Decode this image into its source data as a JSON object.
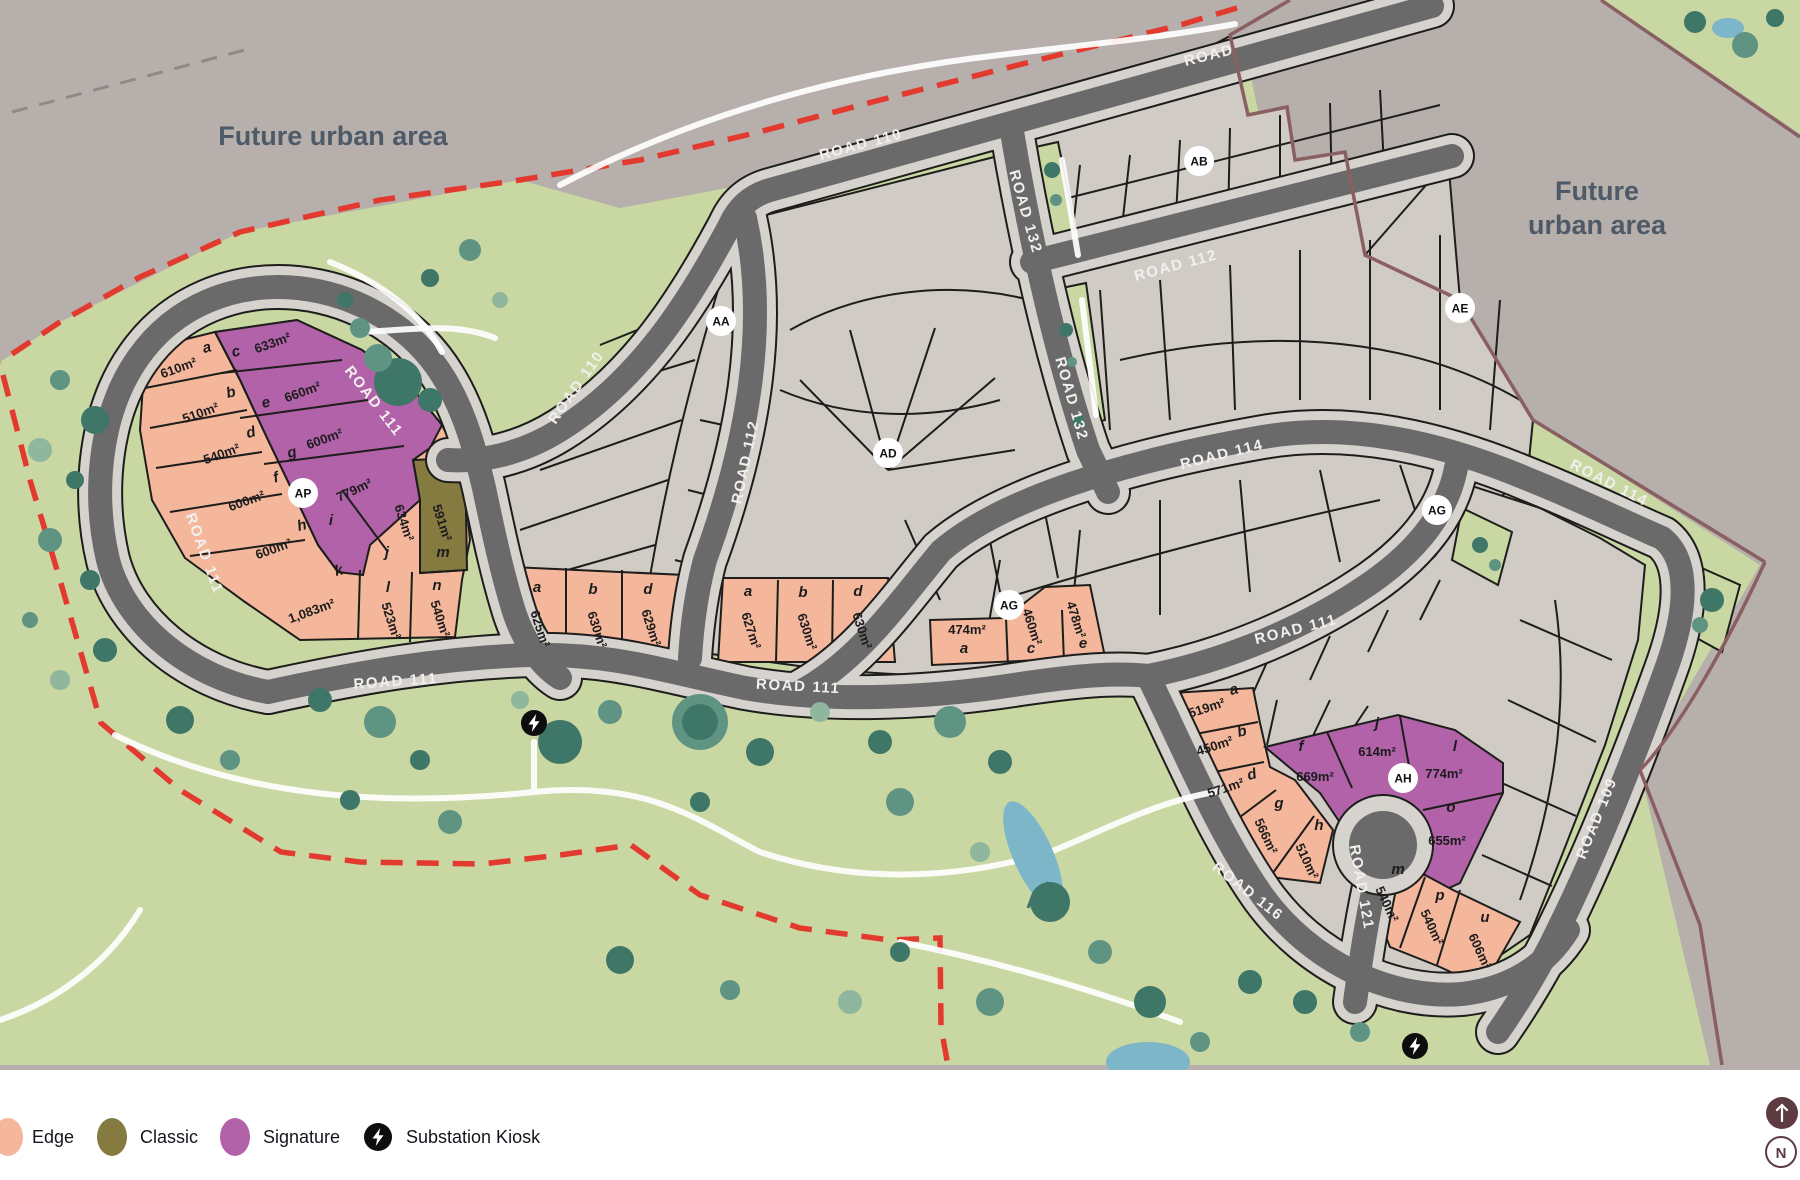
{
  "title": "Masterplan stage map",
  "future_area_labels": [
    {
      "lines": [
        "Future urban area"
      ],
      "x": 333,
      "y": 145
    },
    {
      "lines": [
        "Future",
        "urban area"
      ],
      "x": 1597,
      "y": 200
    }
  ],
  "road_labels": [
    {
      "text": "ROAD 110",
      "x": 862,
      "y": 149,
      "rot": -15
    },
    {
      "text": "ROAD",
      "x": 1210,
      "y": 60,
      "rot": -14
    },
    {
      "text": "ROAD 110",
      "x": 580,
      "y": 390,
      "rot": -55
    },
    {
      "text": "ROAD 111",
      "x": 370,
      "y": 404,
      "rot": 52
    },
    {
      "text": "ROAD 111",
      "x": 200,
      "y": 555,
      "rot": 70
    },
    {
      "text": "ROAD 111",
      "x": 396,
      "y": 686,
      "rot": -4
    },
    {
      "text": "ROAD 111",
      "x": 798,
      "y": 691,
      "rot": 3
    },
    {
      "text": "ROAD 111",
      "x": 1297,
      "y": 634,
      "rot": -14
    },
    {
      "text": "ROAD 112",
      "x": 1177,
      "y": 270,
      "rot": -15
    },
    {
      "text": "ROAD 112",
      "x": 750,
      "y": 463,
      "rot": -78
    },
    {
      "text": "ROAD 132",
      "x": 1021,
      "y": 213,
      "rot": 74
    },
    {
      "text": "ROAD 132",
      "x": 1067,
      "y": 400,
      "rot": 74
    },
    {
      "text": "ROAD 114",
      "x": 1223,
      "y": 459,
      "rot": -14
    },
    {
      "text": "ROAD 114",
      "x": 1607,
      "y": 487,
      "rot": 27
    },
    {
      "text": "ROAD 109",
      "x": 1601,
      "y": 820,
      "rot": -68
    },
    {
      "text": "ROAD 116",
      "x": 1245,
      "y": 895,
      "rot": 38
    },
    {
      "text": "ROAD 121",
      "x": 1357,
      "y": 888,
      "rot": 80
    }
  ],
  "markers": [
    {
      "label": "AA",
      "x": 721,
      "y": 321
    },
    {
      "label": "AB",
      "x": 1199,
      "y": 161
    },
    {
      "label": "AD",
      "x": 888,
      "y": 453
    },
    {
      "label": "AE",
      "x": 1460,
      "y": 308
    },
    {
      "label": "AG",
      "x": 1009,
      "y": 605
    },
    {
      "label": "AG",
      "x": 1437,
      "y": 510
    },
    {
      "label": "AH",
      "x": 1403,
      "y": 778
    },
    {
      "label": "AP",
      "x": 303,
      "y": 493
    }
  ],
  "kiosks": [
    {
      "x": 534,
      "y": 723
    },
    {
      "x": 1415,
      "y": 1046
    }
  ],
  "lots": [
    {
      "letter": "a",
      "size": "610m²",
      "type": "edge",
      "lx": 208,
      "ly": 352,
      "lrot": -15,
      "sx": 180,
      "sy": 372,
      "srot": -20
    },
    {
      "letter": "b",
      "size": "510m²",
      "type": "edge",
      "lx": 232,
      "ly": 397,
      "lrot": -15,
      "sx": 202,
      "sy": 417,
      "srot": -20
    },
    {
      "letter": "c",
      "size": "633m²",
      "type": "signature",
      "lx": 237,
      "ly": 356,
      "lrot": -15,
      "sx": 274,
      "sy": 347,
      "srot": -20
    },
    {
      "letter": "d",
      "size": "540m²",
      "type": "edge",
      "lx": 252,
      "ly": 437,
      "lrot": -15,
      "sx": 223,
      "sy": 458,
      "srot": -20
    },
    {
      "letter": "e",
      "size": "660m²",
      "type": "signature",
      "lx": 267,
      "ly": 407,
      "lrot": -15,
      "sx": 304,
      "sy": 396,
      "srot": -20
    },
    {
      "letter": "f",
      "size": "600m²",
      "type": "edge",
      "lx": 277,
      "ly": 482,
      "lrot": -15,
      "sx": 248,
      "sy": 505,
      "srot": -20
    },
    {
      "letter": "g",
      "size": "600m²",
      "type": "signature",
      "lx": 293,
      "ly": 457,
      "lrot": -15,
      "sx": 326,
      "sy": 443,
      "srot": -20
    },
    {
      "letter": "h",
      "size": "600m²",
      "type": "edge",
      "lx": 303,
      "ly": 530,
      "lrot": -15,
      "sx": 275,
      "sy": 553,
      "srot": -20
    },
    {
      "letter": "i",
      "size": "779m²",
      "type": "signature",
      "lx": 331,
      "ly": 525,
      "lrot": 0,
      "sx": 356,
      "sy": 494,
      "srot": -25
    },
    {
      "letter": "j",
      "size": "634m²",
      "type": "signature",
      "lx": 387,
      "ly": 557,
      "lrot": 0,
      "sx": 400,
      "sy": 524,
      "srot": 72
    },
    {
      "letter": "k",
      "size": "1,083m²",
      "type": "edge",
      "lx": 340,
      "ly": 575,
      "lrot": -15,
      "sx": 313,
      "sy": 615,
      "srot": -20
    },
    {
      "letter": "l",
      "size": "523m²",
      "type": "edge",
      "lx": 388,
      "ly": 592,
      "lrot": 0,
      "sx": 387,
      "sy": 622,
      "srot": 72
    },
    {
      "letter": "m",
      "size": "591m²",
      "type": "classic",
      "lx": 443,
      "ly": 557,
      "lrot": 0,
      "sx": 438,
      "sy": 524,
      "srot": 72
    },
    {
      "letter": "n",
      "size": "540m²",
      "type": "edge",
      "lx": 437,
      "ly": 590,
      "lrot": 0,
      "sx": 436,
      "sy": 620,
      "srot": 72
    },
    {
      "letter": "a",
      "size": "625m²",
      "type": "edge",
      "lx": 537,
      "ly": 592,
      "lrot": 0,
      "sx": 536,
      "sy": 630,
      "srot": 72
    },
    {
      "letter": "b",
      "size": "630m²",
      "type": "edge",
      "lx": 593,
      "ly": 594,
      "lrot": 0,
      "sx": 593,
      "sy": 631,
      "srot": 72
    },
    {
      "letter": "d",
      "size": "629m²",
      "type": "edge",
      "lx": 648,
      "ly": 594,
      "lrot": 0,
      "sx": 647,
      "sy": 629,
      "srot": 72
    },
    {
      "letter": "a",
      "size": "627m²",
      "type": "edge",
      "lx": 748,
      "ly": 596,
      "lrot": 0,
      "sx": 747,
      "sy": 632,
      "srot": 72
    },
    {
      "letter": "b",
      "size": "630m²",
      "type": "edge",
      "lx": 803,
      "ly": 597,
      "lrot": 0,
      "sx": 803,
      "sy": 633,
      "srot": 72
    },
    {
      "letter": "d",
      "size": "630m²",
      "type": "edge",
      "lx": 858,
      "ly": 596,
      "lrot": 0,
      "sx": 858,
      "sy": 632,
      "srot": 72
    },
    {
      "letter": "a",
      "size": "474m²",
      "type": "edge",
      "lx": 964,
      "ly": 653,
      "lrot": 0,
      "sx": 967,
      "sy": 634,
      "srot": 0
    },
    {
      "letter": "c",
      "size": "460m²",
      "type": "edge",
      "lx": 1031,
      "ly": 653,
      "lrot": 0,
      "sx": 1028,
      "sy": 628,
      "srot": 72
    },
    {
      "letter": "e",
      "size": "478m²",
      "type": "edge",
      "lx": 1083,
      "ly": 648,
      "lrot": 0,
      "sx": 1072,
      "sy": 621,
      "srot": 72
    },
    {
      "letter": "a",
      "size": "519m²",
      "type": "edge",
      "lx": 1235,
      "ly": 694,
      "lrot": -15,
      "sx": 1208,
      "sy": 712,
      "srot": -18
    },
    {
      "letter": "b",
      "size": "450m²",
      "type": "edge",
      "lx": 1243,
      "ly": 736,
      "lrot": -15,
      "sx": 1216,
      "sy": 750,
      "srot": -18
    },
    {
      "letter": "d",
      "size": "571m²",
      "type": "edge",
      "lx": 1253,
      "ly": 779,
      "lrot": -15,
      "sx": 1227,
      "sy": 792,
      "srot": -18
    },
    {
      "letter": "f",
      "size": "669m²",
      "type": "signature",
      "lx": 1301,
      "ly": 751,
      "lrot": 0,
      "sx": 1315,
      "sy": 781,
      "srot": 0
    },
    {
      "letter": "g",
      "size": "566m²",
      "type": "edge",
      "lx": 1279,
      "ly": 808,
      "lrot": 0,
      "sx": 1262,
      "sy": 838,
      "srot": 65
    },
    {
      "letter": "h",
      "size": "510m²",
      "type": "edge",
      "lx": 1319,
      "ly": 830,
      "lrot": 0,
      "sx": 1303,
      "sy": 863,
      "srot": 65
    },
    {
      "letter": "j",
      "size": "614m²",
      "type": "signature",
      "lx": 1377,
      "ly": 728,
      "lrot": 0,
      "sx": 1377,
      "sy": 756,
      "srot": 0
    },
    {
      "letter": "l",
      "size": "774m²",
      "type": "signature",
      "lx": 1455,
      "ly": 751,
      "lrot": 0,
      "sx": 1444,
      "sy": 778,
      "srot": 0
    },
    {
      "letter": "o",
      "size": "655m²",
      "type": "signature",
      "lx": 1451,
      "ly": 812,
      "lrot": 0,
      "sx": 1447,
      "sy": 845,
      "srot": 0
    },
    {
      "letter": "m",
      "size": "540m²",
      "type": "edge",
      "lx": 1398,
      "ly": 874,
      "lrot": 0,
      "sx": 1383,
      "sy": 906,
      "srot": 65
    },
    {
      "letter": "p",
      "size": "540m²",
      "type": "edge",
      "lx": 1440,
      "ly": 900,
      "lrot": 0,
      "sx": 1428,
      "sy": 929,
      "srot": 65
    },
    {
      "letter": "u",
      "size": "606m²",
      "type": "edge",
      "lx": 1485,
      "ly": 922,
      "lrot": 0,
      "sx": 1476,
      "sy": 953,
      "srot": 65
    }
  ],
  "legend": {
    "items": [
      {
        "label": "Edge",
        "type": "edge"
      },
      {
        "label": "Classic",
        "type": "classic"
      },
      {
        "label": "Signature",
        "type": "signature"
      },
      {
        "label": "Substation Kiosk",
        "type": "kiosk"
      }
    ]
  },
  "controls": {
    "up_arrow": "↑",
    "north": "N"
  },
  "colors": {
    "edge": "#f4b79b",
    "classic": "#857a40",
    "signature": "#b162a8",
    "road": "#6a6a6a",
    "lot_gray": "#d0cbc5",
    "future_area": "#b6afab",
    "greenspace": "#c9d7a2",
    "boundary_red": "#e23a2e",
    "boundary_maroon": "#8a5f62",
    "water": "#7db6c8",
    "kiosk": "#0d0d0d",
    "control": "#5d3b41"
  }
}
